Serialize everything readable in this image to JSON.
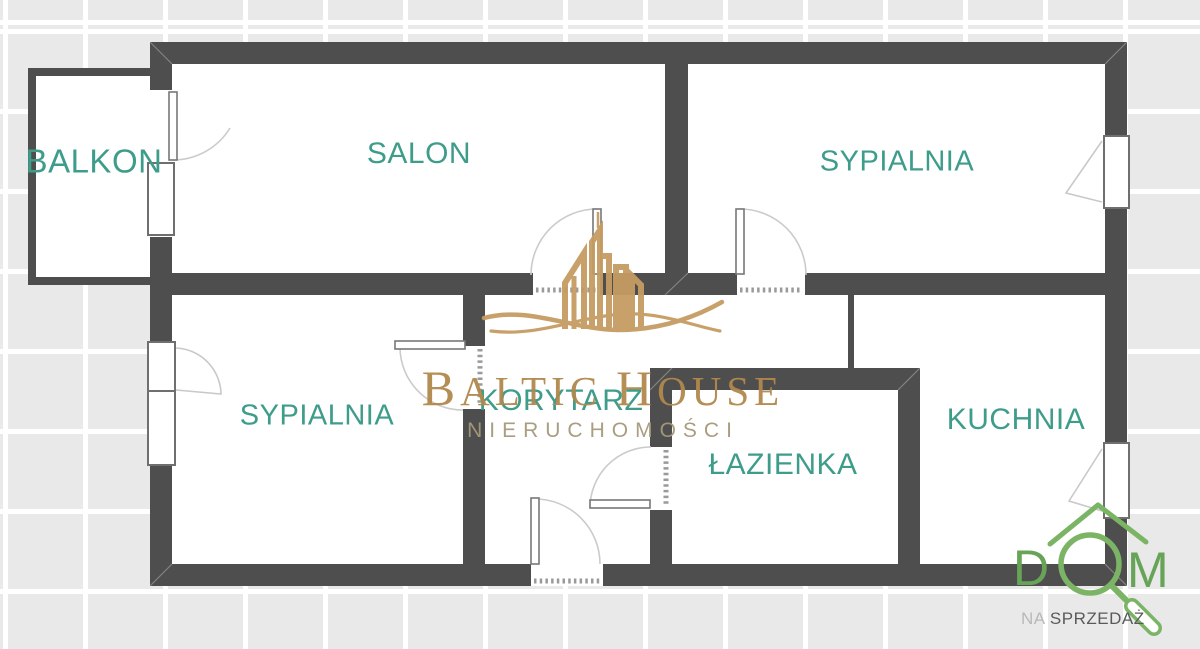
{
  "plan": {
    "wall_color": "#4E4E4E",
    "room_label_color": "#3E9C8B",
    "rooms": [
      {
        "id": "balkon",
        "label": "BALKON"
      },
      {
        "id": "salon",
        "label": "SALON"
      },
      {
        "id": "sypialnia_gorna",
        "label": "SYPIALNIA"
      },
      {
        "id": "sypialnia_dolna",
        "label": "SYPIALNIA"
      },
      {
        "id": "korytarz",
        "label": "KORYTARZ"
      },
      {
        "id": "lazienka",
        "label": "ŁAZIENKA"
      },
      {
        "id": "kuchnia",
        "label": "KUCHNIA"
      }
    ]
  },
  "watermark": {
    "title_parts": [
      "B",
      "ALTIC",
      "H",
      "OUSE"
    ],
    "subtitle": "NIERUCHOMOŚCI",
    "title_color": "#B0884B",
    "subtitle_color": "#A6997B",
    "icon": "skyline-with-wave",
    "icon_color": "#C59C61"
  },
  "agency": {
    "name_letters": {
      "d": "D",
      "m": "M"
    },
    "icon": "house-roof-magnifier",
    "tagline_na": "NA",
    "tagline_sprzedaz": "SPRZEDAŻ",
    "green": "#74AC60",
    "letter_color": "#67A458",
    "tagline_na_color": "#B6BAB6",
    "tagline_color": "#575C57"
  }
}
